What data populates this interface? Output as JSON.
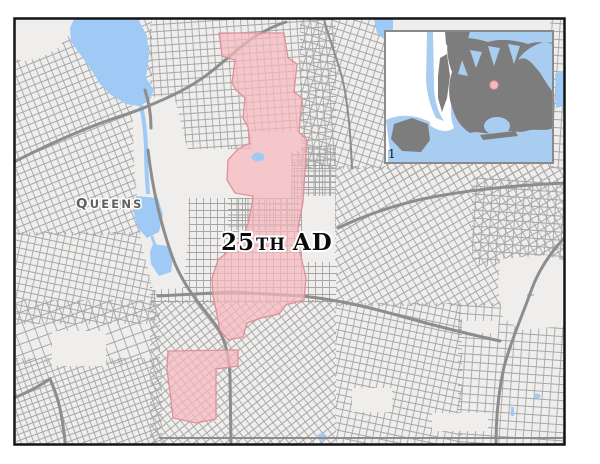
{
  "map": {
    "district_label": {
      "number": "25",
      "suffix": "TH",
      "rest": "AD",
      "full_text": "25th AD"
    },
    "borough_label": {
      "first": "Q",
      "rest": "UEENS",
      "full_text": "Queens"
    },
    "inset": {
      "corner_mark": "1",
      "marker": "district-location-dot"
    }
  },
  "colors": {
    "land": "#efeeed",
    "street": "#a6a6a6",
    "highway": "#8d8d8d",
    "water": "#9ecaf5",
    "district_fill": "rgba(247,184,189,0.72)",
    "district_border": "#e08f9a",
    "frame": "#141414",
    "inset_border": "#8a8a8a",
    "inset_land": "#7d7d7d",
    "inset_water": "#a8cdf0",
    "marker_fill": "#f5babe",
    "marker_stroke": "#da9199",
    "district_text": "#0a0a0a",
    "borough_text": "#5f5f5f",
    "label_halo": "#ffffff"
  }
}
